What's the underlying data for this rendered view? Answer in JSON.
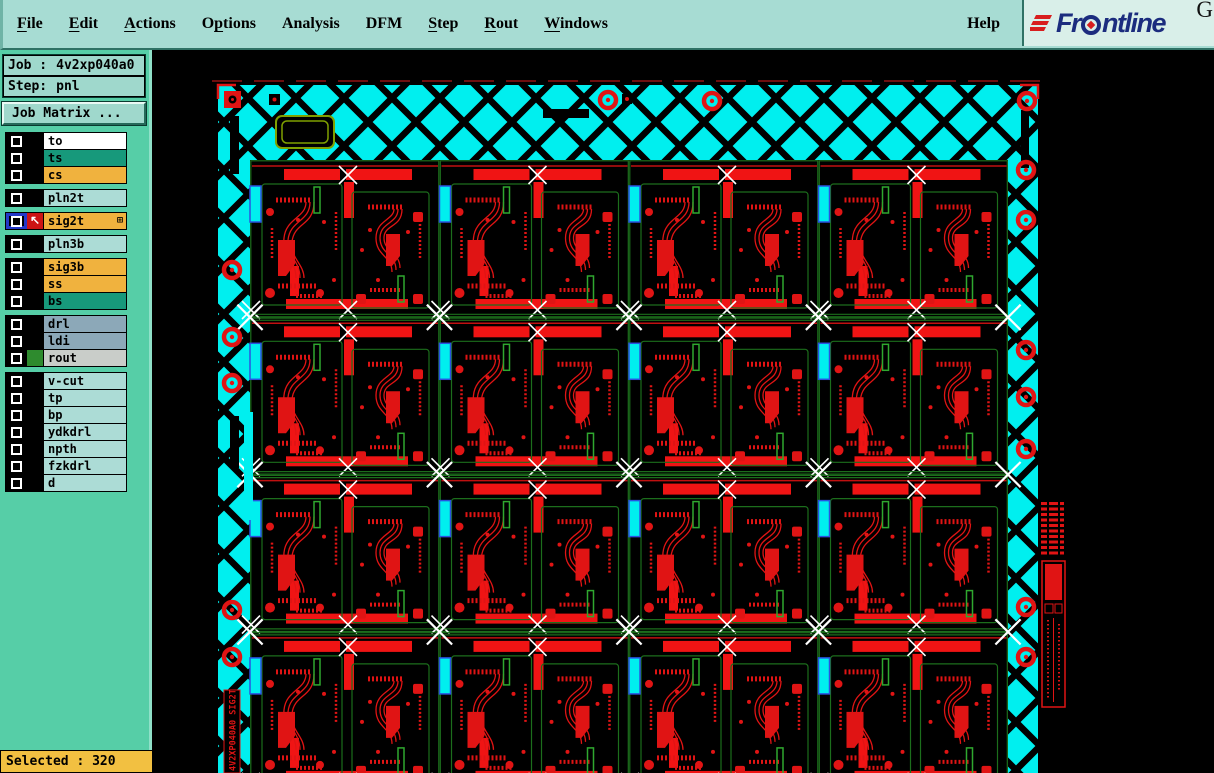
{
  "menubar": {
    "bg": "#A7DCD3",
    "items": [
      {
        "label": "File",
        "underline": 0
      },
      {
        "label": "Edit",
        "underline": 0
      },
      {
        "label": "Actions",
        "underline": 0
      },
      {
        "label": "Options",
        "underline": 1
      },
      {
        "label": "Analysis",
        "underline": -1
      },
      {
        "label": "DFM",
        "underline": -1
      },
      {
        "label": "Step",
        "underline": 0
      },
      {
        "label": "Rout",
        "underline": 0
      },
      {
        "label": "Windows",
        "underline": 0
      }
    ],
    "help": {
      "label": "Help",
      "underline": -1
    },
    "brand": {
      "pre": "Fr",
      "post": "ntline",
      "suffix": "G",
      "navy": "#1B2C7E",
      "red": "#D81E1E"
    }
  },
  "sidebar": {
    "bg": "#56CEA7",
    "job": {
      "label": "Job :",
      "value": "4v2xp040a0"
    },
    "step": {
      "label": "Step:",
      "value": "pnl"
    },
    "job_matrix_button": "Job Matrix ...",
    "layer_groups": [
      {
        "rows": [
          {
            "name": "to",
            "color": "#FFFFFF"
          },
          {
            "name": "ts",
            "color": "#17997B"
          },
          {
            "name": "cs",
            "color": "#F0B23E"
          }
        ]
      },
      {
        "rows": [
          {
            "name": "pln2t",
            "color": "#ACDCD6"
          }
        ]
      },
      {
        "rows": [
          {
            "name": "sig2t",
            "color": "#F0B23E",
            "active": true
          }
        ]
      },
      {
        "rows": [
          {
            "name": "pln3b",
            "color": "#ACDCD6"
          }
        ]
      },
      {
        "rows": [
          {
            "name": "sig3b",
            "color": "#F0B23E"
          },
          {
            "name": "ss",
            "color": "#F0B23E"
          },
          {
            "name": "bs",
            "color": "#17997B"
          }
        ]
      },
      {
        "rows": [
          {
            "name": "drl",
            "color": "#8CA8B8"
          },
          {
            "name": "ldi",
            "color": "#8CA8B8"
          },
          {
            "name": "rout",
            "color": "#C9CDC9",
            "swatch": "#2E8B2E"
          }
        ]
      },
      {
        "rows": [
          {
            "name": "v-cut",
            "color": "#ACDCD6"
          },
          {
            "name": "tp",
            "color": "#ACDCD6"
          },
          {
            "name": "bp",
            "color": "#ACDCD6"
          },
          {
            "name": "ydkdrl",
            "color": "#ACDCD6"
          },
          {
            "name": "npth",
            "color": "#ACDCD6"
          },
          {
            "name": "fzkdrl",
            "color": "#ACDCD6"
          },
          {
            "name": "d",
            "color": "#ACDCD6"
          }
        ]
      }
    ],
    "selected": "Selected : 320"
  },
  "canvas": {
    "panel_label": "4V2XP040A0 SIG2T",
    "colors": {
      "hatch": "#00EFEF",
      "trace": "#E01414",
      "board_outline": "#1C6E1C",
      "fiducial": "#FFFFFF"
    }
  }
}
